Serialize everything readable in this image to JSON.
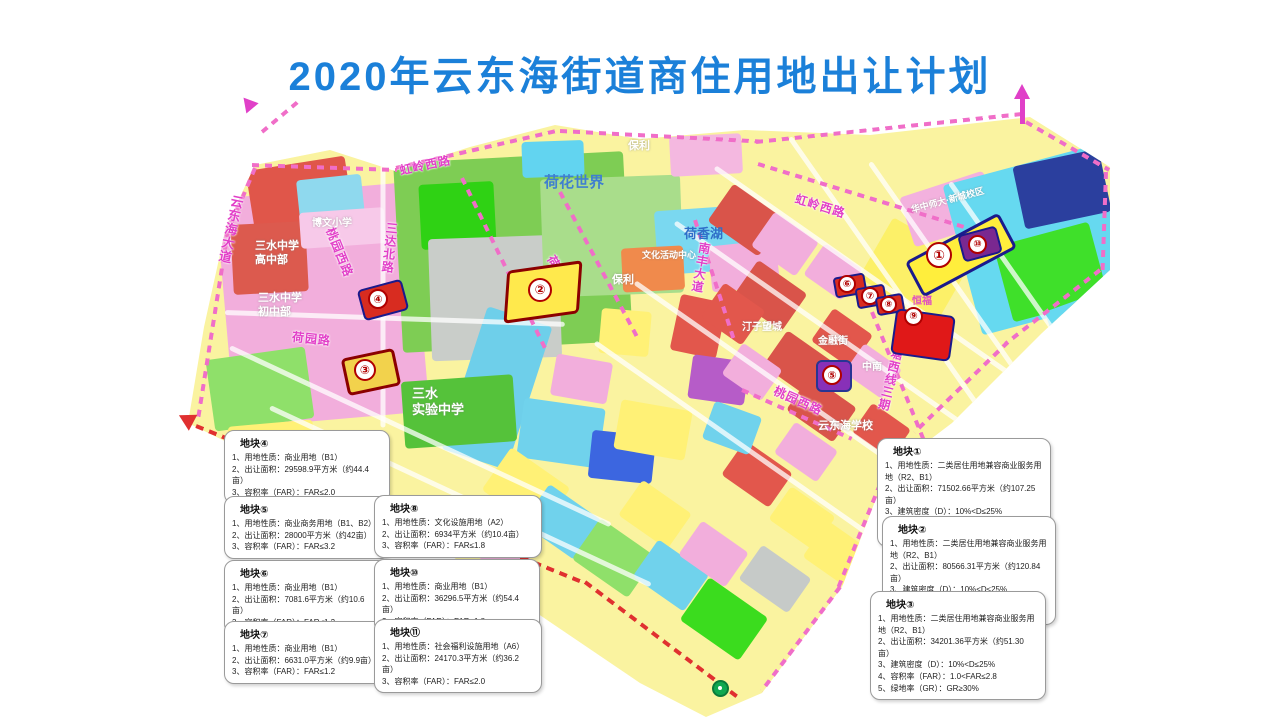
{
  "title": "2020年云东海街道商住用地出让计划",
  "colors": {
    "title_blue": "#1B80D9",
    "road_label_magenta": "#E23FC8",
    "boundary_pink_dash": "#F06EC8",
    "boundary_red_dash": "#E03030",
    "parcel_border_navy": "#1A1A8C",
    "parcel_border_dark_red": "#8B0000",
    "marker_red": "#B00000"
  },
  "roads": [
    {
      "text": "云东海大道"
    },
    {
      "text": "虹岭西路"
    },
    {
      "text": "三达北路"
    },
    {
      "text": "荷园路"
    },
    {
      "text": "桃园西路"
    },
    {
      "text": "荷香路"
    },
    {
      "text": "南丰大道"
    },
    {
      "text": "虹岭西路"
    },
    {
      "text": "桃园西路"
    },
    {
      "text": "塘西线三期"
    }
  ],
  "areas": [
    {
      "text": "博文小学"
    },
    {
      "text": "三水中学\n高中部"
    },
    {
      "text": "三水中学\n初中部"
    },
    {
      "text": "荷花世界"
    },
    {
      "text": "保利"
    },
    {
      "text": "荷香湖"
    },
    {
      "text": "文化活动中心"
    },
    {
      "text": "保利"
    },
    {
      "text": "三水\n实验中学"
    },
    {
      "text": "云东海学校"
    },
    {
      "text": "华中师大·新城校区"
    },
    {
      "text": "华远"
    },
    {
      "text": "恒福"
    },
    {
      "text": "金融街"
    },
    {
      "text": "中南"
    },
    {
      "text": "汀子望城"
    }
  ],
  "markers": [
    {
      "num": "①"
    },
    {
      "num": "②"
    },
    {
      "num": "③"
    },
    {
      "num": "④"
    },
    {
      "num": "⑤"
    },
    {
      "num": "⑥"
    },
    {
      "num": "⑦"
    },
    {
      "num": "⑧"
    },
    {
      "num": "⑨"
    },
    {
      "num": "⑩"
    }
  ],
  "plots": {
    "p1": {
      "title": "地块①",
      "lines": [
        "1、用地性质：二类居住用地兼容商业服务用地（R2、B1）",
        "2、出让面积：71502.66平方米（约107.25亩）",
        "3、建筑密度（D）：10%<D≤25%",
        "4、容积率（FAR）：1.0<FAR≤2.8",
        "5、绿地率（GR）：GR≥30%"
      ]
    },
    "p2": {
      "title": "地块②",
      "lines": [
        "1、用地性质：二类居住用地兼容商业服务用地（R2、B1）",
        "2、出让面积：80566.31平方米（约120.84亩）",
        "3、建筑密度（D）：10%<D≤25%",
        "4、容积率（FAR）：1.0<FAR≤2.8",
        "5、绿地率（GR）：GR≥30%"
      ]
    },
    "p3": {
      "title": "地块③",
      "lines": [
        "1、用地性质：二类居住用地兼容商业服务用地（R2、B1）",
        "2、出让面积：34201.36平方米（约51.30亩）",
        "3、建筑密度（D）：10%<D≤25%",
        "4、容积率（FAR）：1.0<FAR≤2.8",
        "5、绿地率（GR）：GR≥30%"
      ]
    },
    "p4": {
      "title": "地块④",
      "lines": [
        "1、用地性质：商业用地（B1）",
        "2、出让面积：29598.9平方米（约44.4亩）",
        "3、容积率（FAR）：FAR≤2.0"
      ]
    },
    "p5": {
      "title": "地块⑤",
      "lines": [
        "1、用地性质：商业商务用地（B1、B2）",
        "2、出让面积：28000平方米（约42亩）",
        "3、容积率（FAR）：FAR≤3.2"
      ]
    },
    "p6": {
      "title": "地块⑥",
      "lines": [
        "1、用地性质：商业用地（B1）",
        "2、出让面积：7081.6平方米（约10.6亩）",
        "3、容积率（FAR）：FAR≤1.2"
      ]
    },
    "p7": {
      "title": "地块⑦",
      "lines": [
        "1、用地性质：商业用地（B1）",
        "2、出让面积：6631.0平方米（约9.9亩）",
        "3、容积率（FAR）：FAR≤1.2"
      ]
    },
    "p8": {
      "title": "地块⑧",
      "lines": [
        "1、用地性质：文化设施用地（A2）",
        "2、出让面积：6934平方米（约10.4亩）",
        "3、容积率（FAR）：FAR≤1.8"
      ]
    },
    "p10": {
      "title": "地块⑩",
      "lines": [
        "1、用地性质：商业用地（B1）",
        "2、出让面积：36296.5平方米（约54.4亩）",
        "3、容积率（FAR）：FAR≤1.8"
      ]
    },
    "p11": {
      "title": "地块⑪",
      "lines": [
        "1、用地性质：社会福利设施用地（A6）",
        "2、出让面积：24170.3平方米（约36.2亩）",
        "3、容积率（FAR）：FAR≤2.0"
      ]
    }
  }
}
